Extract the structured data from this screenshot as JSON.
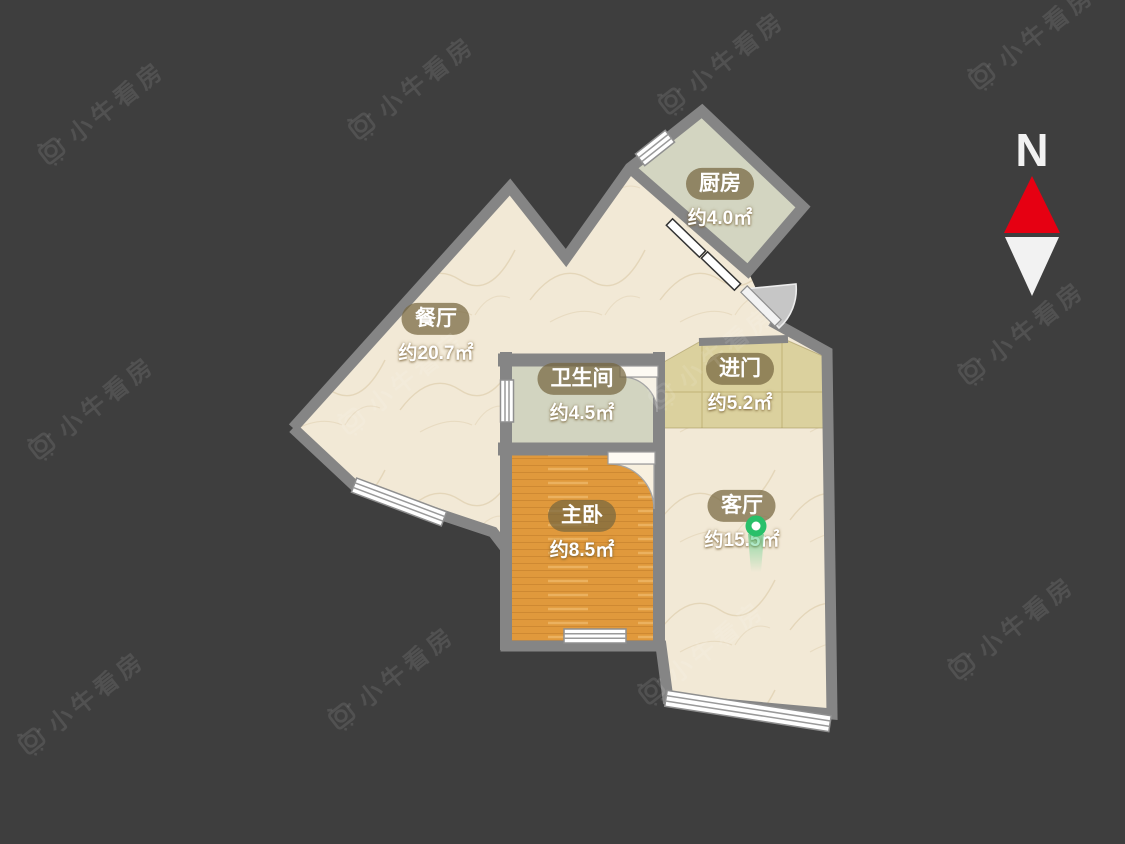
{
  "palette": {
    "background": "#3e3e3e",
    "wall": "#858585",
    "cream": "#f2e9d6",
    "sage": "#d3d5c1",
    "khaki": "#dbd19e",
    "wood_orange": "#e0993c",
    "marker_green": "#29c06a",
    "compass_red": "#e60012",
    "compass_white": "#f2f2f2"
  },
  "compass": {
    "label": "N"
  },
  "watermark": {
    "text": "小牛看房"
  },
  "rooms": [
    {
      "id": "kitchen",
      "name": "厨房",
      "area": "约4.0㎡",
      "color": "#d3d5c1"
    },
    {
      "id": "dining",
      "name": "餐厅",
      "area": "约20.7㎡",
      "color": "#f2e9d6"
    },
    {
      "id": "bathroom",
      "name": "卫生间",
      "area": "约4.5㎡",
      "color": "#d2d4c0"
    },
    {
      "id": "entry",
      "name": "进门",
      "area": "约5.2㎡",
      "color": "#dbd19e"
    },
    {
      "id": "master_bedroom",
      "name": "主卧",
      "area": "约8.5㎡",
      "color": "#e0993c"
    },
    {
      "id": "living",
      "name": "客厅",
      "area": "约15.5㎡",
      "color": "#f2e9d6"
    }
  ]
}
